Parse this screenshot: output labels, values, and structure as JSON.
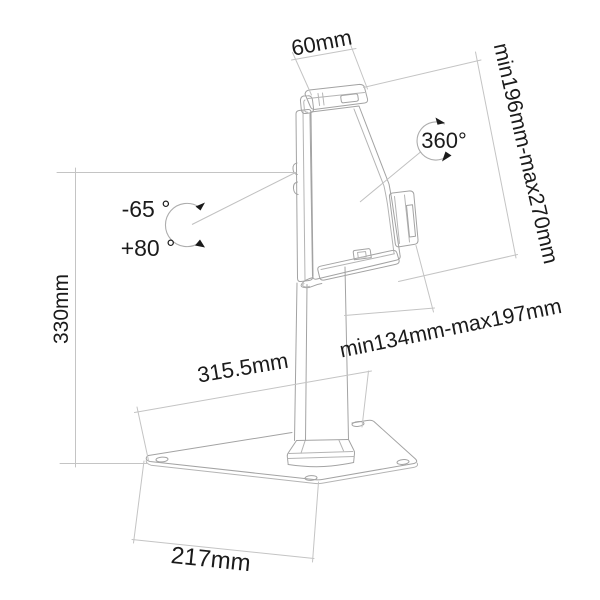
{
  "figure": "Tablet desk stand dimensional line drawing",
  "background": "#ffffff",
  "colors": {
    "object_line": "#a3a3a3",
    "dimension_line": "#c4c4c4",
    "label_text": "#1b1b1b",
    "arrowheads": "#1a1a1a"
  },
  "labels": {
    "clamp_width": "60mm",
    "holder_length_range": "min196mm-max270mm",
    "rotation": "360°",
    "tilt_negative": "-65 °",
    "tilt_positive": "+80 °",
    "total_height": "330mm",
    "holder_height_range": "min134mm-max197mm",
    "base_depth": "315.5mm",
    "base_width": "217mm"
  }
}
